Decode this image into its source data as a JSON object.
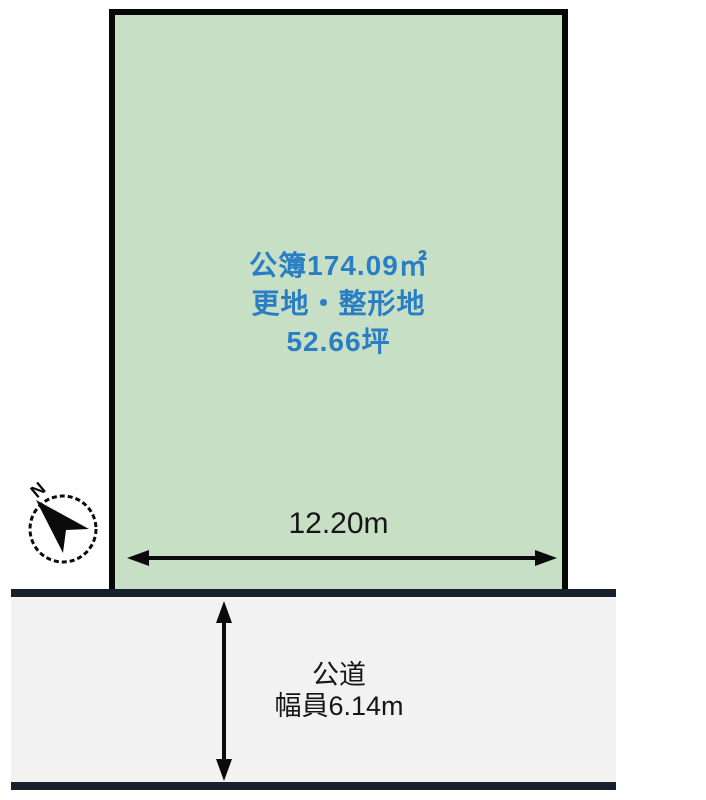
{
  "diagram": {
    "kind": "land-plot-site-plan",
    "parcel": {
      "registered_area": "公簿174.09㎡",
      "condition": "更地・整形地",
      "area_tsubo": "52.66坪",
      "frontage": "12.20m"
    },
    "road": {
      "name": "公道",
      "width": "幅員6.14m"
    },
    "compass": {
      "north_label": "N"
    },
    "colors": {
      "parcel_fill": "#c7dfc5",
      "parcel_border": "#070707",
      "parcel_text_blue": "#2a7ec4",
      "road_fill": "#f2f2f2",
      "road_edge": "#16212c",
      "dimension_text": "#161616",
      "background": "#ffffff"
    }
  }
}
